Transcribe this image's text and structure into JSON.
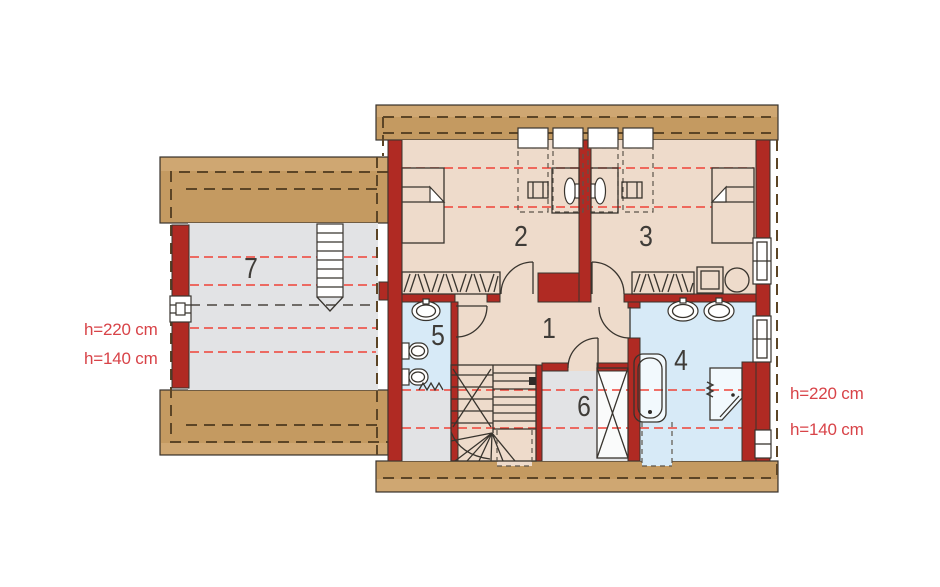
{
  "plan": {
    "kind": "attic-floor-plan"
  },
  "rooms": [
    {
      "number": "1"
    },
    {
      "number": "2"
    },
    {
      "number": "3"
    },
    {
      "number": "4"
    },
    {
      "number": "5"
    },
    {
      "number": "6"
    },
    {
      "number": "7"
    }
  ],
  "annotations": {
    "left": [
      {
        "text": "h=220 cm"
      },
      {
        "text": "h=140 cm"
      }
    ],
    "right": [
      {
        "text": "h=220 cm"
      },
      {
        "text": "h=140 cm"
      }
    ]
  },
  "colors": {
    "wall_red": "#b02a23",
    "roof_tan": "#c49a61",
    "roof_tan_light": "#cfa772",
    "floor_beige": "#eedbcb",
    "floor_blue": "#d7eaf7",
    "floor_gray": "#e2e3e5",
    "height_line_red": "#ef4337",
    "roof_dash_dark": "#5c4526",
    "annotation_text_red": "#d84348"
  }
}
